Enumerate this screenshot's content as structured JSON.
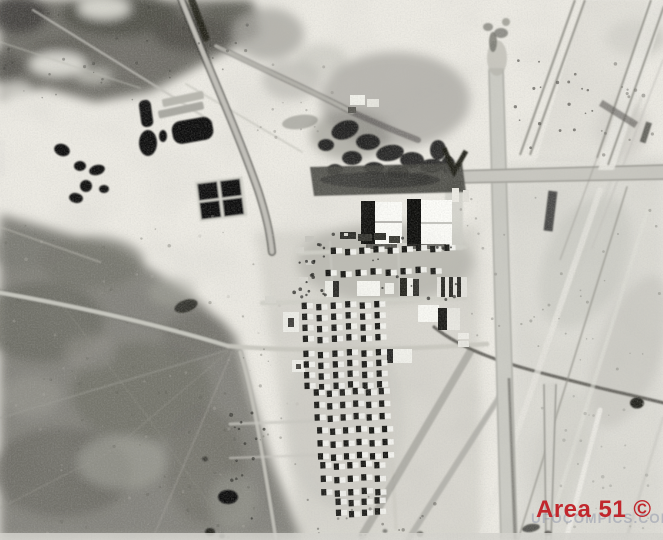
{
  "photo": {
    "description": "Black-and-white aerial satellite photograph of the Area 51 air base: desert terrain, runway at upper right, hangars, barracks grid, ponds and access roads"
  },
  "caption": {
    "text": "Area 51 ©",
    "color": "#c1272d"
  },
  "watermark": {
    "text": "UFOCOMPICS.COM",
    "color": "#8e94a8"
  },
  "palette": {
    "desert_bright": "#edebe4",
    "desert_right": "#dddcd5",
    "terrain_dark": "#6f6e67",
    "scrub_olive": "#83827b",
    "road_light": "#ccccc4",
    "feature_black": "#0e0e0c",
    "roof_white": "#fcfcf8"
  }
}
